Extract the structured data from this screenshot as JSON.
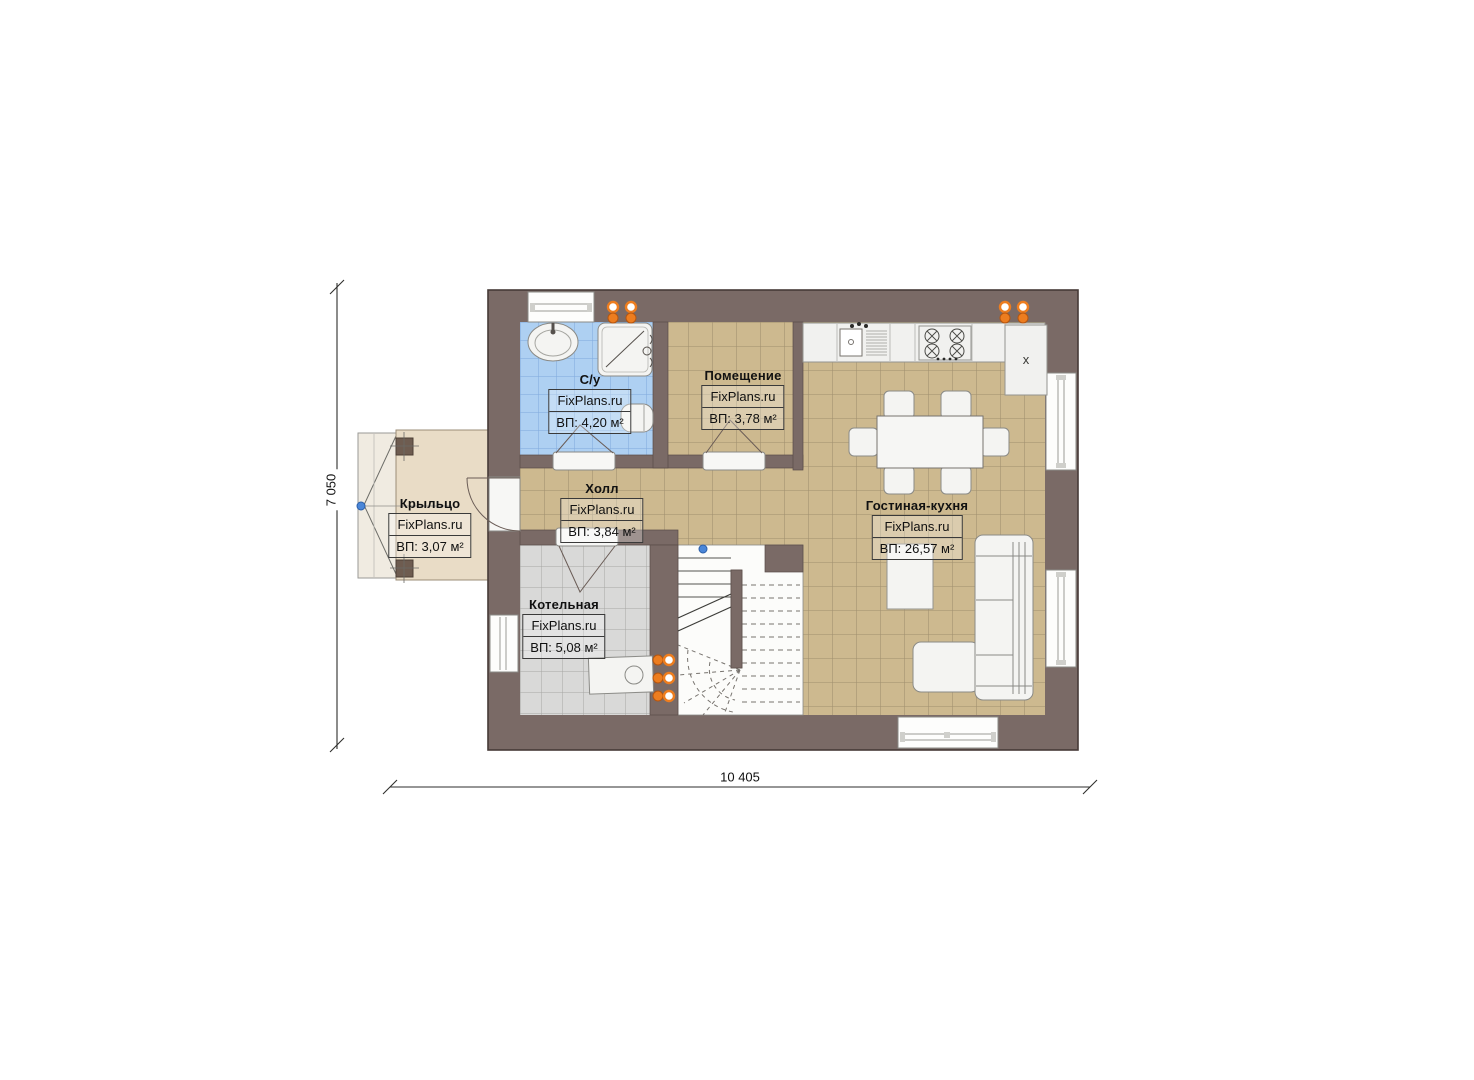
{
  "brand": "FixPlans.ru",
  "plan": {
    "rooms": [
      {
        "name": "С/у",
        "area": "ВП: 4,20 м²"
      },
      {
        "name": "Помещение",
        "area": "ВП: 3,78 м²"
      },
      {
        "name": "Крыльцо",
        "area": "ВП: 3,07 м²"
      },
      {
        "name": "Холл",
        "area": "ВП: 3,84 м²"
      },
      {
        "name": "Котельная",
        "area": "ВП: 5,08 м²"
      },
      {
        "name": "Гостиная-кухня",
        "area": "ВП: 26,57 м²"
      }
    ],
    "dimensions": {
      "width": "10 405",
      "height": "7 050"
    },
    "fridge_label": "x",
    "colors": {
      "wall": "#7a6a66",
      "floor_tan": "#cdb98f",
      "tile_blue": "#aed0f2",
      "tile_gray": "#d9d9d8",
      "porch": "#e9dcc6",
      "radiator": "#ed7d1f"
    }
  }
}
